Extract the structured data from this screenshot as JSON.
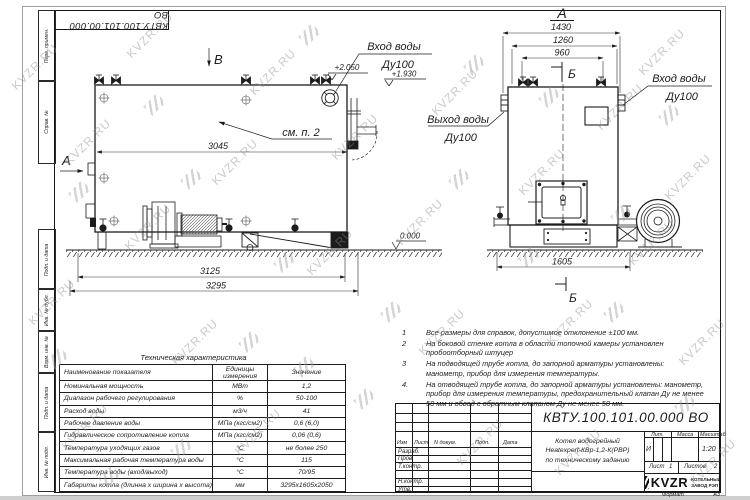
{
  "watermark": {
    "text": "KVZR.RU"
  },
  "corner_stamp": {
    "doc_number": "КВТУ.100.101.00.000 ВО"
  },
  "margin_stamps": [
    "Перв. примен.",
    "Справ. №",
    "Подп. и дата",
    "Инв. № дубл.",
    "Взам. инв. №",
    "Подп. и дата",
    "Инв. № подл."
  ],
  "left_view": {
    "view_label": "В",
    "section_label": "А",
    "note_ref": "см. п. 2",
    "dim_inner": "3045",
    "dim_frame": "3125",
    "dim_overall": "3295",
    "elev_top": "+2.050",
    "elev_nozzle": "+1.930",
    "elev_ground": "0.000",
    "inlet_line1": "Вход воды",
    "inlet_line2": "Ду100"
  },
  "right_view": {
    "view_label": "А",
    "axis_top": "Б",
    "axis_bottom": "Б",
    "dim_a": "1430",
    "dim_b": "1260",
    "dim_c": "960",
    "dim_base": "1605",
    "outlet_line1": "Выход воды",
    "outlet_line2": "Ду100",
    "inlet_line1": "Вход воды",
    "inlet_line2": "Ду100"
  },
  "notes": [
    {
      "num": "1",
      "text": "Все размеры для справок, допустимое отклонение  ±100 мм."
    },
    {
      "num": "2",
      "text": "На боковой стенке котла в области топочной камеры установлен пробоотборный штуцер"
    },
    {
      "num": "3",
      "text": "На  подводящей трубе котла, до запорной арматуры установлены: манометр, прибор для измерения температуры."
    },
    {
      "num": "4.",
      "text": "На отводящей трубе котла, до запорной арматуры установлены: манометр, прибор для измерения температуры, предохранительный клапан Ду не менее 50 мм и обвод с обратным клапаном Ду не менее 50 мм."
    }
  ],
  "tech_table": {
    "title": "Техническая характеристика",
    "headers": [
      "Наименование показателя",
      "Единицы измерения",
      "Значение"
    ],
    "rows": [
      [
        "Номинальная мощность",
        "МВт",
        "1,2"
      ],
      [
        "Диапазон рабочего регулирования",
        "%",
        "50-100"
      ],
      [
        "Расход воды",
        "м3/ч",
        "41"
      ],
      [
        "Рабочее давление воды",
        "МПа (кгс/см2)",
        "0,6 (6,0)"
      ],
      [
        "Гидравлическое сопротивление котла",
        "МПа (кгс/см2)",
        "0,06 (0,6)"
      ],
      [
        "Температура уходящих газов",
        "°С",
        "не более 250"
      ],
      [
        "Максимальная рабочая температура воды",
        "°С",
        "115"
      ],
      [
        "Температура воды (вход/выход)",
        "°С",
        "70/95"
      ],
      [
        "Габариты котла (длинна х ширина х высота)",
        "мм",
        "3295х1605х2050"
      ]
    ]
  },
  "title_block": {
    "doc_number": "КВТУ.100.101.00.000  ВО",
    "header_cols": [
      "Изм",
      "Лист",
      "N докум.",
      "Подп.",
      "Дата"
    ],
    "row_labels": [
      "Разраб.",
      "Пров.",
      "Т.контр.",
      "Н.контр.",
      "Утв."
    ],
    "product_line1": "Котел водогрейный",
    "product_line2": "Heatexpert-КВр-1,2-К(РВР)",
    "product_line3": "по техническому заданию",
    "lit_label": "Лит.",
    "mass_label": "Масса",
    "scale_label": "Масштаб",
    "lit_value": "И",
    "scale_value": "1:20",
    "sheet_label": "Лист",
    "sheet_value": "1",
    "sheets_label": "Листов",
    "sheets_value": "2",
    "logo_text": "KVZR",
    "company_line1": "КОТЕЛЬНЫЙ",
    "company_line2": "ЗАВОД РЭП",
    "format_label": "Формат",
    "format_value": "А3"
  }
}
